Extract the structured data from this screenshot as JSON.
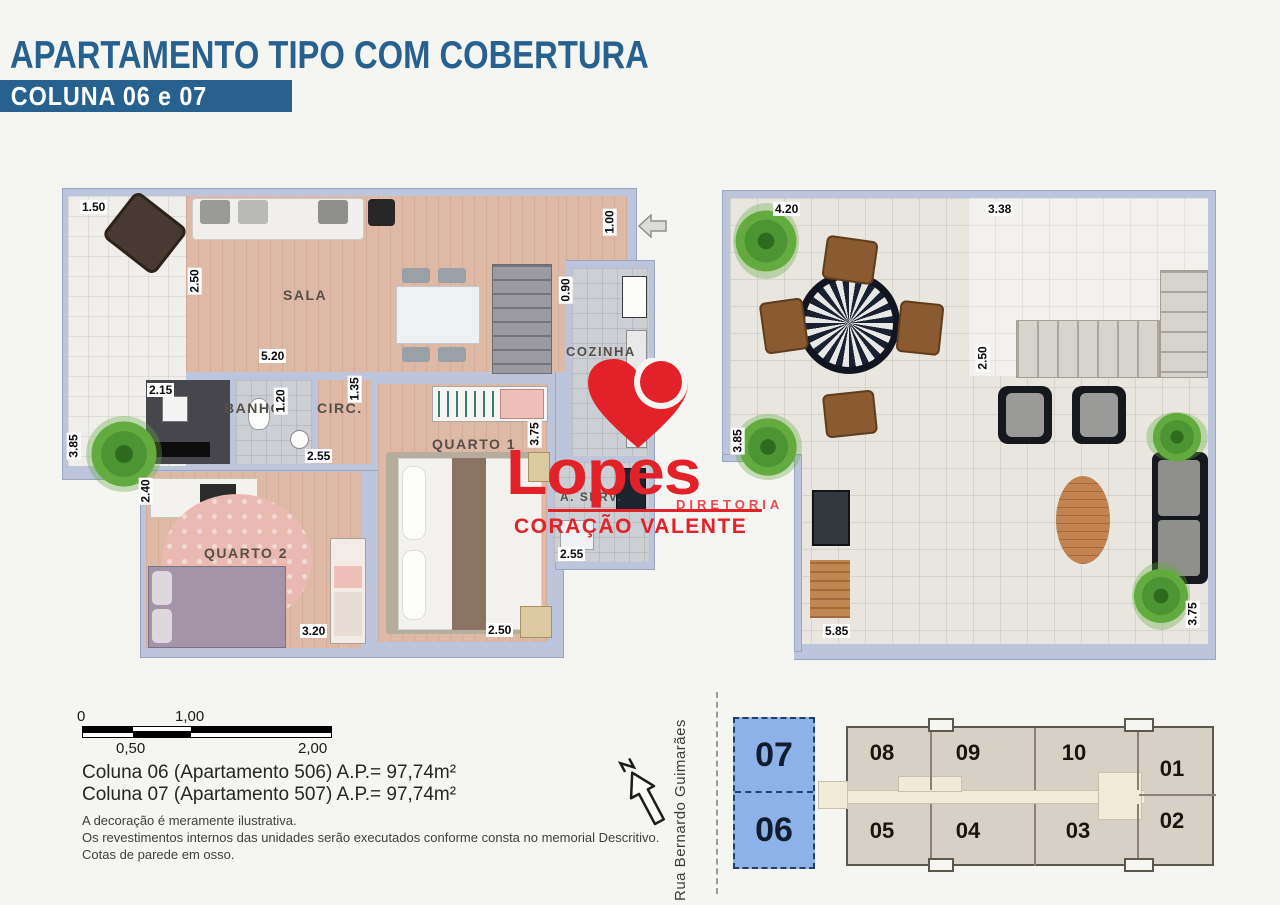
{
  "colors": {
    "brand_blue": "#27618f",
    "logo_red": "#e32128",
    "highlight_blue": "#8db2e8",
    "building_beige": "#d7d0c4"
  },
  "header": {
    "title": "APARTAMENTO TIPO COM COBERTURA",
    "subtitle": "COLUNA 06 e 07"
  },
  "logo": {
    "brand": "Lopes",
    "division": "DIRETORIA",
    "tagline": "CORAÇÃO VALENTE"
  },
  "plan_apartment": {
    "rooms": {
      "sala": "SALA",
      "banho": "BANHO",
      "circ": "CIRC.",
      "cozinha": "COZINHA",
      "quarto1": "QUARTO 1",
      "quarto2": "QUARTO 2",
      "aserv": "A. SERV."
    },
    "dims": {
      "varanda_width": "1.50",
      "varanda_depth": "3.85",
      "sala_wall": "2.50",
      "sala_width": "5.20",
      "hall_width": "2.15",
      "banho_depth": "1.20",
      "circ_depth": "1.35",
      "entrada": "1.00",
      "cozinha_door": "0.90",
      "quarto2_depth": "2.40",
      "quarto2_top": "2.55",
      "quarto2_width": "3.20",
      "quarto1_depth": "3.75",
      "quarto1_width": "2.50",
      "aserv_width": "2.55"
    }
  },
  "plan_cobertura": {
    "dims": {
      "terraco_top": "4.20",
      "escada_top": "3.38",
      "escada_side": "2.50",
      "terraco_left": "3.85",
      "terraco_bottom": "5.85",
      "terraco_right": "3.75"
    }
  },
  "scalebar": {
    "zero": "0",
    "half": "0,50",
    "one": "1,00",
    "two": "2,00"
  },
  "info": {
    "line1": "Coluna 06 (Apartamento 506) A.P.= 97,74m²",
    "line2": "Coluna 07 (Apartamento 507) A.P.= 97,74m²"
  },
  "disclaimer": {
    "line1": "A decoração é meramente ilustrativa.",
    "line2": "Os revestimentos internos das unidades serão executados conforme consta no memorial Descritivo.",
    "line3": "Cotas de parede em osso."
  },
  "keyplan": {
    "street": "Rua Bernardo Guimarães",
    "units": {
      "u07": "07",
      "u06": "06",
      "u08": "08",
      "u09": "09",
      "u10": "10",
      "u01": "01",
      "u05": "05",
      "u04": "04",
      "u03": "03",
      "u02": "02"
    }
  }
}
